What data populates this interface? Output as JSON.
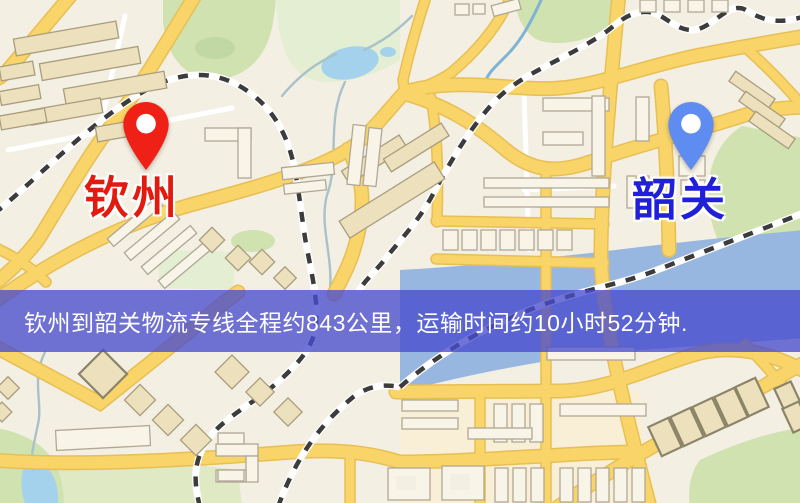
{
  "map": {
    "origin": {
      "name": "钦州"
    },
    "destination": {
      "name": "韶关"
    }
  },
  "banner": {
    "text": "钦州到韶关物流专线全程约843公里，运输时间约10小时52分钟."
  },
  "route": {
    "origin": "钦州",
    "destination": "韶关",
    "distance_text": "全程约843公里",
    "duration_text": "运输时间约10小时52分钟"
  },
  "theme": {
    "map-bg": "#f4efe3",
    "road": "#f8d469",
    "road-casing": "#e8bf55",
    "rail": "#3c3c3c",
    "park": "#cfe2b0",
    "park-dark": "#c2d8a4",
    "park-pale": "#e4eed3",
    "field": "#dfe9c4",
    "block": "#f8efd6",
    "water": "#98b7e0",
    "lake": "#a4d2ec",
    "stream": "#a9c2ca",
    "stream-blue": "#7fb3d4",
    "bld": "#ece0bd",
    "bld-stroke": "#a89d7e",
    "bld-cream": "#f8f4e8",
    "bld-stroke2": "#b0a896",
    "bld-heavy-stroke": "#8b8468",
    "origin-pin": "#ef2015",
    "origin-label": "#e31b0e",
    "dest-pin": "#5f8cf0",
    "dest-label": "#2020d8",
    "banner-bg": "rgba(72,76,205,0.78)",
    "banner-text": "#ffffff"
  }
}
